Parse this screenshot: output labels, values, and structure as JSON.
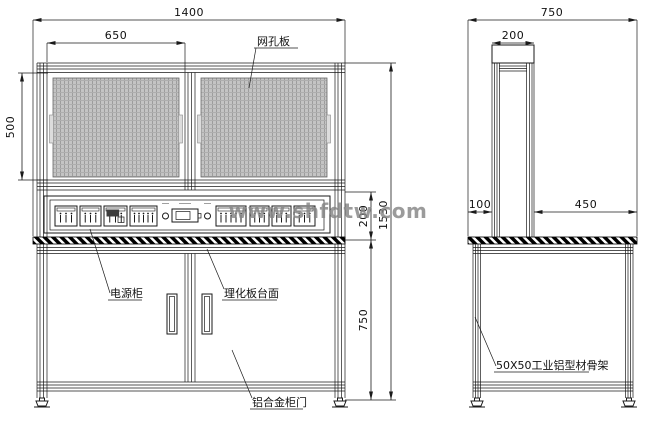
{
  "watermark": "www.shfdtw.com",
  "colors": {
    "line": "#1a1a1a",
    "mesh_fill": "#c4c4c4",
    "mesh_grid": "#9d9d9d",
    "watermark": "#868686"
  },
  "front_view": {
    "dimensions": {
      "total_width": "1400",
      "mesh_panel_width": "650",
      "mesh_panel_height": "500",
      "control_section_height": "200",
      "bench_height": "750",
      "total_height": "1530"
    },
    "labels": {
      "mesh_panel": "网孔板",
      "power_cabinet": "电源柜",
      "countertop": "理化板台面",
      "cabinet_door": "铝合金柜门"
    },
    "control_panel": {
      "modules": [
        {
          "type": "switch-3",
          "x": 55,
          "w": 22
        },
        {
          "type": "switch-3",
          "x": 80,
          "w": 21
        },
        {
          "type": "display",
          "x": 104,
          "w": 23
        },
        {
          "type": "switch-5",
          "x": 130,
          "w": 27
        },
        {
          "type": "indicator",
          "x": 162,
          "w": 7
        },
        {
          "type": "meter",
          "x": 172,
          "w": 26
        },
        {
          "type": "indicator",
          "x": 204,
          "w": 7
        },
        {
          "type": "switch-5",
          "x": 216,
          "w": 30
        },
        {
          "type": "switch-3",
          "x": 250,
          "w": 19
        },
        {
          "type": "switch-3",
          "x": 272,
          "w": 19
        },
        {
          "type": "switch-3",
          "x": 294,
          "w": 21
        }
      ]
    }
  },
  "side_view": {
    "dimensions": {
      "total_depth": "750",
      "column_depth": "200",
      "front_offset": "100",
      "table_depth": "450"
    },
    "labels": {
      "frame": "50X50工业铝型材骨架"
    }
  }
}
